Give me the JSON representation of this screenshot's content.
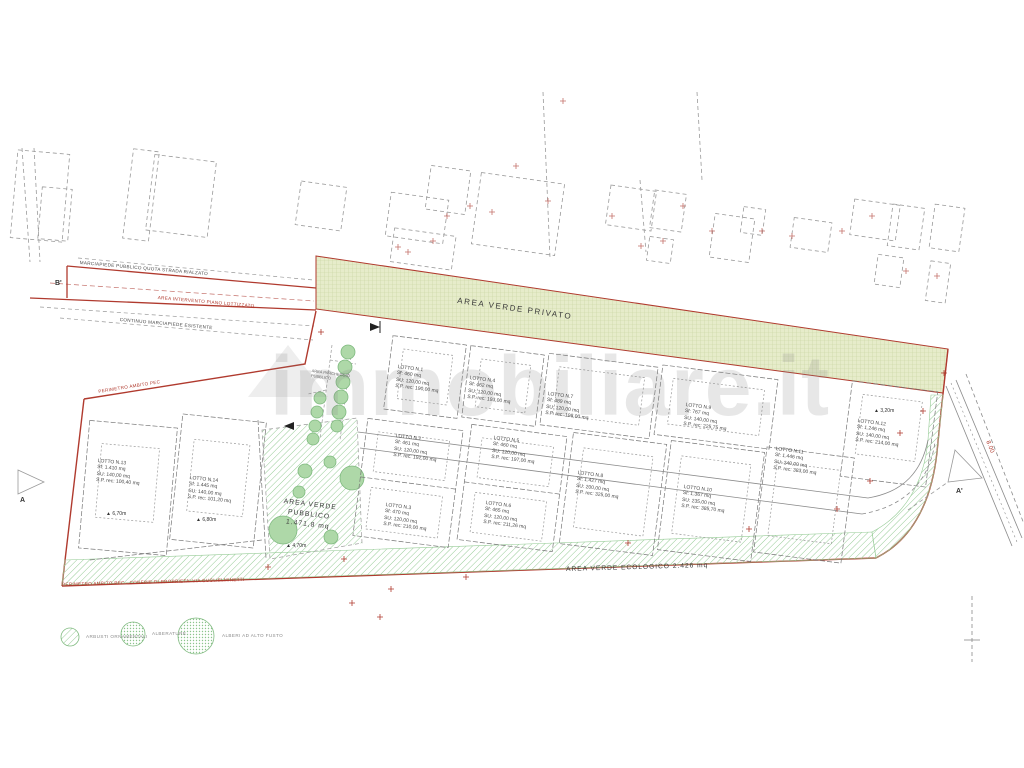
{
  "watermark": {
    "text": "immobiliare.it"
  },
  "colors": {
    "boundary_red": "#b03a2e",
    "green_band_fill": "#e6ecca",
    "hatch_green": "#97cc97",
    "tree_green": "#aed8a8",
    "dash_gray": "#9a9a9a"
  },
  "areas": {
    "verde_privato": "AREA VERDE PRIVATO",
    "verde_pubblico_l1": "AREA VERDE",
    "verde_pubblico_l2": "PUBBLICO",
    "verde_pubblico_l3": "1.471,8 mq",
    "verde_ecologico": "AREA VERDE ECOLOGICO 2.426 mq",
    "parcheggio_l1": "AREA PARCHEGGIO",
    "parcheggio_l2": "PUBBLICO"
  },
  "road_labels": {
    "marciapiede_pubblico": "MARCIAPIEDE PUBBLICO QUOTA STRADA RIALZATO",
    "area_intervento": "AREA INTERVENTO PIANO LOTTIZZATO",
    "continuo_marciapiede": "CONTINUO MARCIAPIEDE ESISTENTE",
    "perimetro_pec": "PERIMETRO AMBITO PEC",
    "perimetro_confine": "PERIMETRO AMBITO PEC - CONFINE DI PROPRIETA' VIA GUGLIELMINETTI",
    "larghezza_strada": "8.00"
  },
  "section_markers": {
    "b_prime": "B'",
    "a": "A",
    "a_prime": "A'"
  },
  "elevation_icon": "▲",
  "elevations": [
    {
      "value": "6,70m"
    },
    {
      "value": "6,80m"
    },
    {
      "value": "4,70m"
    },
    {
      "value": "3,20m"
    }
  ],
  "lots": [
    {
      "name": "LOTTO N.1",
      "sf": "Sf: 460 mq",
      "su": "SU: 120,00 mq",
      "sp": "S.P. rec: 190,00 mq"
    },
    {
      "name": "LOTTO N.2",
      "sf": "Sf: 461 mq",
      "su": "SU: 120,00 mq",
      "sp": "S.P. rec: 192,00 mq"
    },
    {
      "name": "LOTTO N.3",
      "sf": "Sf: 470 mq",
      "su": "SU: 120,00 mq",
      "sp": "S.P. rec: 210,00 mq"
    },
    {
      "name": "LOTTO N.4",
      "sf": "Sf: 462 mq",
      "su": "SU: 120,00 mq",
      "sp": "S.P. rec: 193,00 mq"
    },
    {
      "name": "LOTTO N.5",
      "sf": "Sf: 460 mq",
      "su": "SU: 120,00 mq",
      "sp": "S.P. rec: 197,00 mq"
    },
    {
      "name": "LOTTO N.6",
      "sf": "Sf: 465 mq",
      "su": "SU: 120,00 mq",
      "sp": "S.P. rec: 211,26 mq"
    },
    {
      "name": "LOTTO N.7",
      "sf": "Sf: 489 mq",
      "su": "SU: 120,00 mq",
      "sp": "S.P. rec: 198,00 mq"
    },
    {
      "name": "LOTTO N.8",
      "sf": "Sf: 1.427 mq",
      "su": "SU: 200,00 mq",
      "sp": "S.P. rec: 325,00 mq"
    },
    {
      "name": "LOTTO N.9",
      "sf": "Sf: 767 mq",
      "su": "SU: 140,00 mq",
      "sp": "S.P. rec: 225,75 mq"
    },
    {
      "name": "LOTTO N.10",
      "sf": "Sf: 1.367 mq",
      "su": "SU: 235,00 mq",
      "sp": "S.P. rec: 385,70 mq"
    },
    {
      "name": "LOTTO N.11",
      "sf": "Sf: 1.446 mq",
      "su": "SU: 240,00 mq",
      "sp": "S.P. rec: 383,00 mq"
    },
    {
      "name": "LOTTO N.12",
      "sf": "Sf: 1.246 mq",
      "su": "SU: 140,00 mq",
      "sp": "S.P. rec: 214,00 mq"
    },
    {
      "name": "LOTTO N.13",
      "sf": "Sf: 1.410 mq",
      "su": "SU: 140,00 mq",
      "sp": "S.P. rec: 100,40 mq"
    },
    {
      "name": "LOTTO N.14",
      "sf": "Sf: 1.445 mq",
      "su": "SU: 140,00 mq",
      "sp": "S.P. rec: 101,20 mq"
    }
  ],
  "legend": {
    "items": [
      {
        "label": "ARBUSTI ORNAMENTALI"
      },
      {
        "label": "ALBERATURE"
      },
      {
        "label": "ALBERI AD ALTO FUSTO"
      }
    ]
  }
}
